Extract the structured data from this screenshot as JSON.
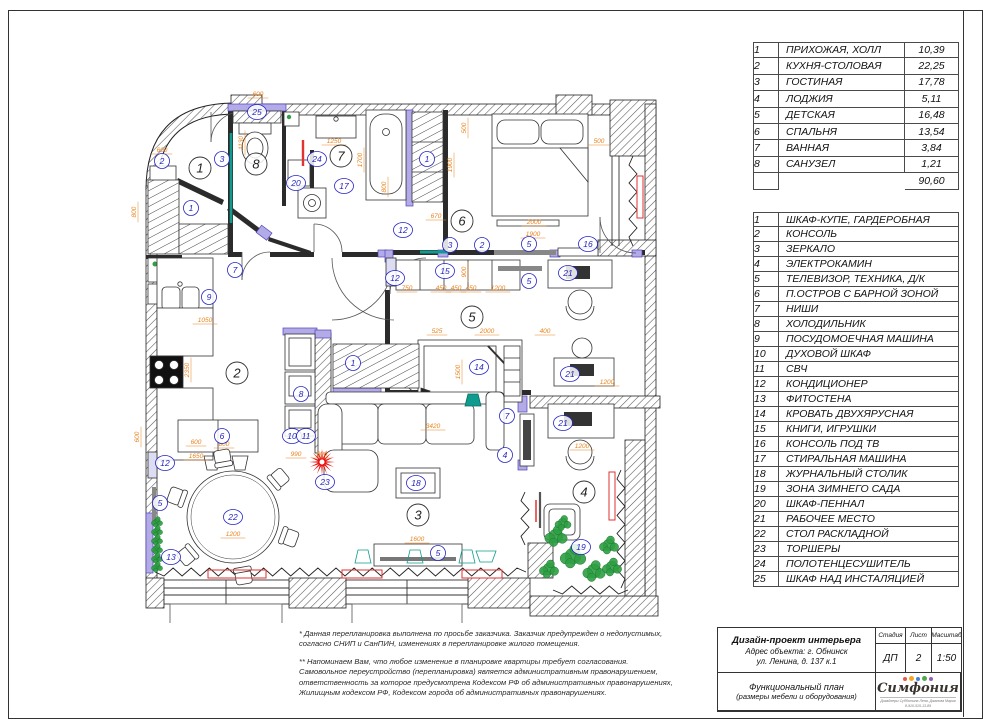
{
  "colors": {
    "dim_orange": "#e8831d",
    "label_blue": "#2525c4",
    "teal": "#0f9b8e",
    "green": "#2f9e44",
    "red": "#e23232",
    "purple_wall": "#b3abe8",
    "wall_dark": "#2b2b2b"
  },
  "room_table": {
    "rows": [
      {
        "n": "1",
        "name": "ПРИХОЖАЯ, ХОЛЛ",
        "area": "10,39"
      },
      {
        "n": "2",
        "name": "КУХНЯ-СТОЛОВАЯ",
        "area": "22,25"
      },
      {
        "n": "3",
        "name": "ГОСТИНАЯ",
        "area": "17,78"
      },
      {
        "n": "4",
        "name": "ЛОДЖИЯ",
        "area": "5,11"
      },
      {
        "n": "5",
        "name": "ДЕТСКАЯ",
        "area": "16,48"
      },
      {
        "n": "6",
        "name": "СПАЛЬНЯ",
        "area": "13,54"
      },
      {
        "n": "7",
        "name": "ВАННАЯ",
        "area": "3,84"
      },
      {
        "n": "8",
        "name": "САНУЗЕЛ",
        "area": "1,21"
      }
    ],
    "total": "90,60"
  },
  "furniture_table": {
    "rows": [
      {
        "n": "1",
        "name": "ШКАФ-КУПЕ, ГАРДЕРОБНАЯ"
      },
      {
        "n": "2",
        "name": "КОНСОЛЬ"
      },
      {
        "n": "3",
        "name": "ЗЕРКАЛО"
      },
      {
        "n": "4",
        "name": "ЭЛЕКТРОКАМИН"
      },
      {
        "n": "5",
        "name": "ТЕЛЕВИЗОР, ТЕХНИКА, Д/К"
      },
      {
        "n": "6",
        "name": "П.ОСТРОВ С БАРНОЙ ЗОНОЙ"
      },
      {
        "n": "7",
        "name": "НИШИ"
      },
      {
        "n": "8",
        "name": "ХОЛОДИЛЬНИК"
      },
      {
        "n": "9",
        "name": "ПОСУДОМОЕЧНАЯ МАШИНА"
      },
      {
        "n": "10",
        "name": "ДУХОВОЙ ШКАФ"
      },
      {
        "n": "11",
        "name": "СВЧ"
      },
      {
        "n": "12",
        "name": "КОНДИЦИОНЕР"
      },
      {
        "n": "13",
        "name": "ФИТОСТЕНА"
      },
      {
        "n": "14",
        "name": "КРОВАТЬ ДВУХЯРУСНАЯ"
      },
      {
        "n": "15",
        "name": "КНИГИ, ИГРУШКИ"
      },
      {
        "n": "16",
        "name": "КОНСОЛЬ ПОД ТВ"
      },
      {
        "n": "17",
        "name": "СТИРАЛЬНАЯ МАШИНА"
      },
      {
        "n": "18",
        "name": "ЖУРНАЛЬНЫЙ СТОЛИК"
      },
      {
        "n": "19",
        "name": "ЗОНА ЗИМНЕГО САДА"
      },
      {
        "n": "20",
        "name": "ШКАФ-ПЕННАЛ"
      },
      {
        "n": "21",
        "name": "РАБОЧЕЕ МЕСТО"
      },
      {
        "n": "22",
        "name": "СТОЛ РАСКЛАДНОЙ"
      },
      {
        "n": "23",
        "name": "ТОРШЕРЫ"
      },
      {
        "n": "24",
        "name": "ПОЛОТЕНЦЕСУШИТЕЛЬ"
      },
      {
        "n": "25",
        "name": "ШКАФ НАД ИНСТАЛЯЦИЕЙ"
      }
    ]
  },
  "notes": {
    "note1": "* Данная перепланировка выполнена по просьбе заказчика. Заказчик предупрежден о недопустимых,\nсогласно СНИП и СанПИН, изменениях в перепланировке жилого помещения.",
    "note2": "** Напоминаем Вам, что любое изменение в планировке квартиры требует согласования.\nСамовольное переустройство (перепланировка) является административным правонарушением,\nответственность за которое предусмотрена Кодексом РФ об административных правонарушениях,\nЖилищным кодексом РФ, Кодексом города об административных правонарушениях."
  },
  "title_block": {
    "project": "Дизайн-проект интерьера",
    "address1": "Адрес объекта: г. Обнинск",
    "address2": "ул. Ленина, д. 137 к.1",
    "stage_label": "Стадия",
    "sheet_label": "Лист",
    "scale_label": "Масштаб",
    "stage": "ДП",
    "sheet": "2",
    "scale": "1:50",
    "doc_title": "Функциональный план",
    "doc_subtitle": "(размеры мебели и оборудования)",
    "logo": "Симфония",
    "logo_sub": "Дизайнеры Субботина Лена, Джанова Мария\n8-910-515-13-89"
  },
  "plan": {
    "rooms": [
      {
        "n": "1",
        "x": 200,
        "y": 168
      },
      {
        "n": "2",
        "x": 237,
        "y": 373
      },
      {
        "n": "3",
        "x": 418,
        "y": 515
      },
      {
        "n": "4",
        "x": 584,
        "y": 492
      },
      {
        "n": "5",
        "x": 472,
        "y": 317
      },
      {
        "n": "6",
        "x": 462,
        "y": 221
      },
      {
        "n": "7",
        "x": 341,
        "y": 156
      },
      {
        "n": "8",
        "x": 256,
        "y": 164
      }
    ],
    "items": [
      {
        "n": "25",
        "x": 257,
        "y": 112
      },
      {
        "n": "2",
        "x": 162,
        "y": 161
      },
      {
        "n": "3",
        "x": 222,
        "y": 159
      },
      {
        "n": "1",
        "x": 191,
        "y": 208
      },
      {
        "n": "24",
        "x": 317,
        "y": 159
      },
      {
        "n": "20",
        "x": 296,
        "y": 183
      },
      {
        "n": "17",
        "x": 344,
        "y": 186
      },
      {
        "n": "1",
        "x": 427,
        "y": 159
      },
      {
        "n": "12",
        "x": 403,
        "y": 230
      },
      {
        "n": "3",
        "x": 450,
        "y": 245
      },
      {
        "n": "2",
        "x": 482,
        "y": 245
      },
      {
        "n": "5",
        "x": 529,
        "y": 244
      },
      {
        "n": "16",
        "x": 588,
        "y": 244
      },
      {
        "n": "12",
        "x": 395,
        "y": 278
      },
      {
        "n": "15",
        "x": 445,
        "y": 271
      },
      {
        "n": "21",
        "x": 568,
        "y": 273
      },
      {
        "n": "5",
        "x": 529,
        "y": 281
      },
      {
        "n": "14",
        "x": 479,
        "y": 367
      },
      {
        "n": "1",
        "x": 353,
        "y": 363
      },
      {
        "n": "7",
        "x": 235,
        "y": 270
      },
      {
        "n": "9",
        "x": 209,
        "y": 297
      },
      {
        "n": "8",
        "x": 301,
        "y": 394
      },
      {
        "n": "10",
        "x": 292,
        "y": 436
      },
      {
        "n": "11",
        "x": 306,
        "y": 436
      },
      {
        "n": "6",
        "x": 222,
        "y": 436
      },
      {
        "n": "12",
        "x": 165,
        "y": 463
      },
      {
        "n": "5",
        "x": 160,
        "y": 503
      },
      {
        "n": "13",
        "x": 171,
        "y": 557
      },
      {
        "n": "22",
        "x": 233,
        "y": 517
      },
      {
        "n": "23",
        "x": 325,
        "y": 482
      },
      {
        "n": "18",
        "x": 416,
        "y": 483
      },
      {
        "n": "5",
        "x": 438,
        "y": 553
      },
      {
        "n": "7",
        "x": 507,
        "y": 416
      },
      {
        "n": "4",
        "x": 505,
        "y": 455
      },
      {
        "n": "21",
        "x": 570,
        "y": 374
      },
      {
        "n": "21",
        "x": 563,
        "y": 423
      },
      {
        "n": "19",
        "x": 581,
        "y": 547
      }
    ],
    "dims": [
      {
        "t": "600",
        "x": 258,
        "y": 96
      },
      {
        "t": "600",
        "x": 162,
        "y": 152
      },
      {
        "t": "800",
        "x": 136,
        "y": 212,
        "r": 1
      },
      {
        "t": "1130",
        "x": 243,
        "y": 143,
        "r": 1
      },
      {
        "t": "1250",
        "x": 334,
        "y": 143
      },
      {
        "t": "1700",
        "x": 362,
        "y": 160,
        "r": 1
      },
      {
        "t": "800",
        "x": 386,
        "y": 187,
        "r": 1
      },
      {
        "t": "500",
        "x": 466,
        "y": 128,
        "r": 1
      },
      {
        "t": "500",
        "x": 599,
        "y": 143
      },
      {
        "t": "1900",
        "x": 452,
        "y": 165,
        "r": 1
      },
      {
        "t": "2000",
        "x": 534,
        "y": 224
      },
      {
        "t": "1900",
        "x": 533,
        "y": 236
      },
      {
        "t": "670",
        "x": 436,
        "y": 218
      },
      {
        "t": "750",
        "x": 407,
        "y": 290
      },
      {
        "t": "450",
        "x": 441,
        "y": 290
      },
      {
        "t": "450",
        "x": 456,
        "y": 290
      },
      {
        "t": "450",
        "x": 471,
        "y": 290
      },
      {
        "t": "1200",
        "x": 498,
        "y": 290
      },
      {
        "t": "525",
        "x": 437,
        "y": 333
      },
      {
        "t": "2000",
        "x": 487,
        "y": 333
      },
      {
        "t": "400",
        "x": 545,
        "y": 333
      },
      {
        "t": "1500",
        "x": 460,
        "y": 372,
        "r": 1
      },
      {
        "t": "3420",
        "x": 433,
        "y": 428
      },
      {
        "t": "1200",
        "x": 607,
        "y": 384
      },
      {
        "t": "1200",
        "x": 582,
        "y": 448
      },
      {
        "t": "1050",
        "x": 205,
        "y": 322
      },
      {
        "t": "2350",
        "x": 189,
        "y": 370,
        "r": 1
      },
      {
        "t": "600",
        "x": 139,
        "y": 437,
        "r": 1
      },
      {
        "t": "600",
        "x": 196,
        "y": 444
      },
      {
        "t": "800",
        "x": 224,
        "y": 446
      },
      {
        "t": "1650",
        "x": 196,
        "y": 458
      },
      {
        "t": "1200",
        "x": 233,
        "y": 536
      },
      {
        "t": "1600",
        "x": 417,
        "y": 541
      },
      {
        "t": "990",
        "x": 296,
        "y": 456
      },
      {
        "t": "800",
        "x": 322,
        "y": 456
      },
      {
        "t": "900",
        "x": 466,
        "y": 272,
        "r": 1
      }
    ],
    "plants": [
      {
        "x": 556,
        "y": 536,
        "s": 7
      },
      {
        "x": 573,
        "y": 556,
        "s": 8
      },
      {
        "x": 594,
        "y": 571,
        "s": 7
      },
      {
        "x": 609,
        "y": 545,
        "s": 6
      },
      {
        "x": 549,
        "y": 569,
        "s": 6
      },
      {
        "x": 612,
        "y": 567,
        "s": 6
      },
      {
        "x": 563,
        "y": 523,
        "s": 5
      }
    ]
  }
}
